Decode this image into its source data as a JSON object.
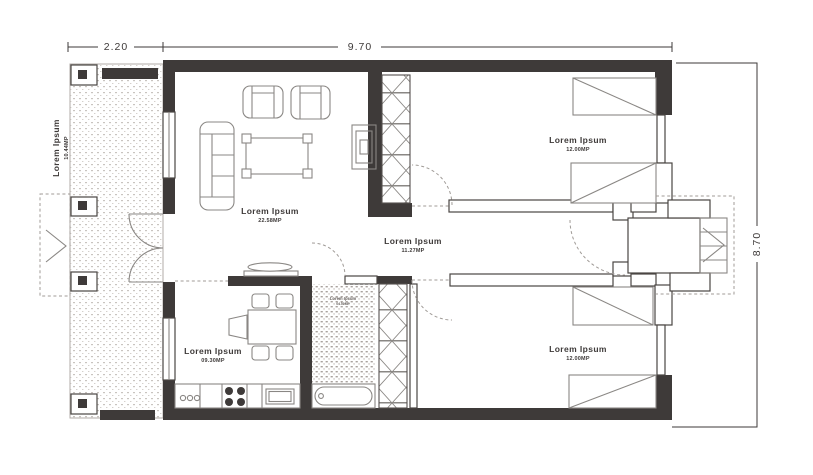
{
  "dimensions": {
    "terrace_width": "2.20",
    "building_width": "9.70",
    "building_depth": "8.70"
  },
  "rooms": {
    "terrace": {
      "label": "Lorem Ipsum",
      "area": "10.44MP"
    },
    "living_room": {
      "label": "Lorem Ipsum",
      "area": "22.58MP"
    },
    "hallway": {
      "label": "Lorem Ipsum",
      "area": "11.27MP"
    },
    "kitchen": {
      "label": "Lorem Ipsum",
      "area": "09.30MP"
    },
    "bathroom": {
      "label": "Lorem Ipsum",
      "area": "04.50MP"
    },
    "bedroom_top": {
      "label": "Lorem Ipsum",
      "area": "12.00MP"
    },
    "bedroom_bottom": {
      "label": "Lorem Ipsum",
      "area": "12.00MP"
    }
  },
  "colors": {
    "wall": "#3e3a39",
    "furniture_line": "#8a8784",
    "text": "#3e3a39"
  }
}
